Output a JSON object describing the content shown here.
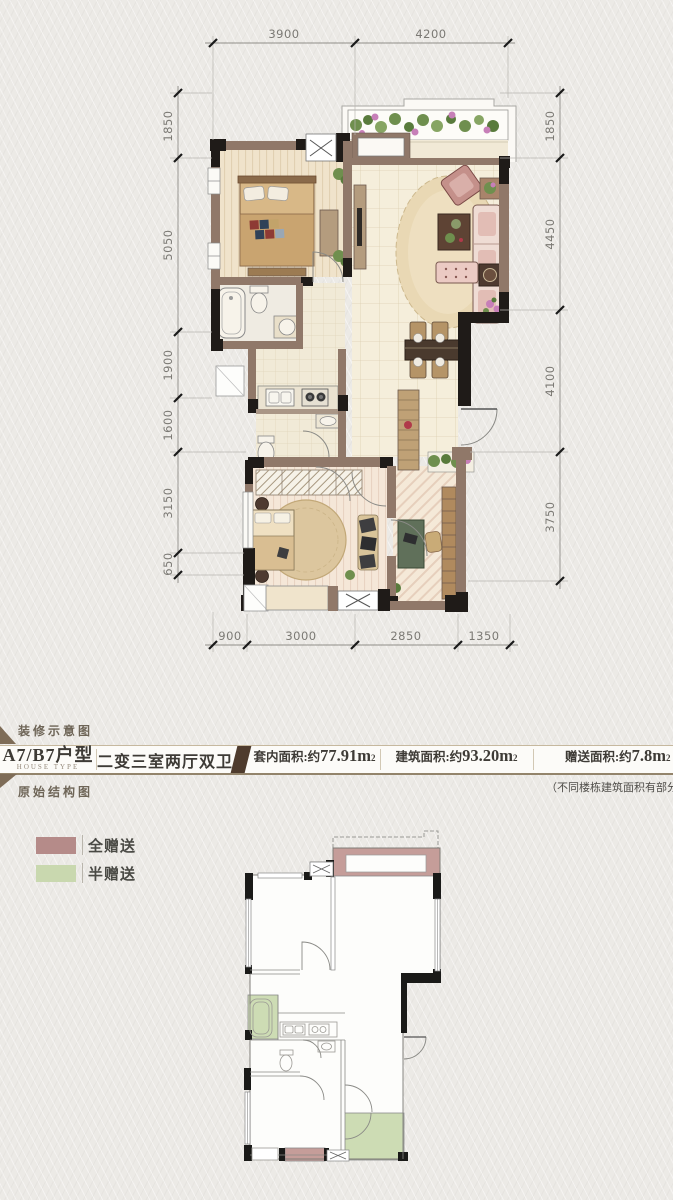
{
  "page": {
    "background": "#ECEAE6"
  },
  "decorated_plan": {
    "dims_top": [
      "3900",
      "4200"
    ],
    "dims_left": [
      "1850",
      "5050",
      "1900",
      "1600",
      "3150",
      "650"
    ],
    "dims_right": [
      "1850",
      "4450",
      "4100",
      "3750"
    ],
    "dims_bottom": [
      "900",
      "3000",
      "2850",
      "1350"
    ]
  },
  "info": {
    "decorated_label": "装修示意图",
    "structural_label": "原始结构图",
    "house_type": "A7/B7户型",
    "house_type_en": "HOUSE TYPE",
    "layout": "二变三室两厅双卫",
    "inner_area_label": "套内面积:约",
    "inner_area_value": "77.91m",
    "inner_area_sup": "2",
    "build_area_label": "建筑面积:约",
    "build_area_value": "93.20m",
    "build_area_sup": "2",
    "gift_area_label": "赠送面积:约",
    "gift_area_value": "7.8m",
    "gift_area_sup": "2",
    "note": "（不同楼栋建筑面积有部分差异）"
  },
  "legend": {
    "items": [
      {
        "label": "全赠送",
        "color": "#B58B89"
      },
      {
        "label": "半赠送",
        "color": "#C9D8AF"
      }
    ]
  }
}
